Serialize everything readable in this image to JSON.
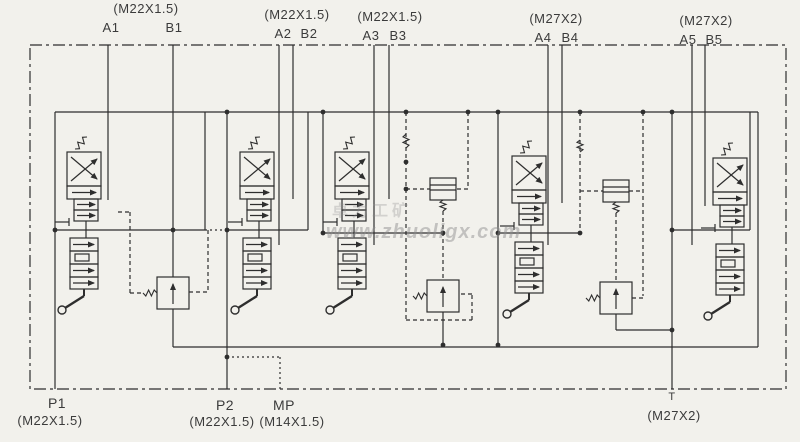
{
  "colors": {
    "background": "#f2f1ec",
    "ink": "#2e2e2e",
    "label": "#3b3b3b",
    "watermark": "#8f8f8f"
  },
  "top_ports": [
    {
      "thread": "(M22X1.5)",
      "a": "A1",
      "b": "B1"
    },
    {
      "thread": "(M22X1.5)",
      "a": "A2",
      "b": "B2"
    },
    {
      "thread": "(M22X1.5)",
      "a": "A3",
      "b": "B3"
    },
    {
      "thread": "(M27X2)",
      "a": "A4",
      "b": "B4"
    },
    {
      "thread": "(M27X2)",
      "a": "A5",
      "b": "B5"
    }
  ],
  "bottom_ports": [
    {
      "name": "P1",
      "thread": "(M22X1.5)"
    },
    {
      "name": "P2",
      "thread": "(M22X1.5)"
    },
    {
      "name": "MP",
      "thread": "(M14X1.5)"
    },
    {
      "name": "T",
      "thread": "(M27X2)"
    }
  ],
  "watermark": {
    "line1": "卓力工矿",
    "line2": "www.zhuoligx.com"
  }
}
